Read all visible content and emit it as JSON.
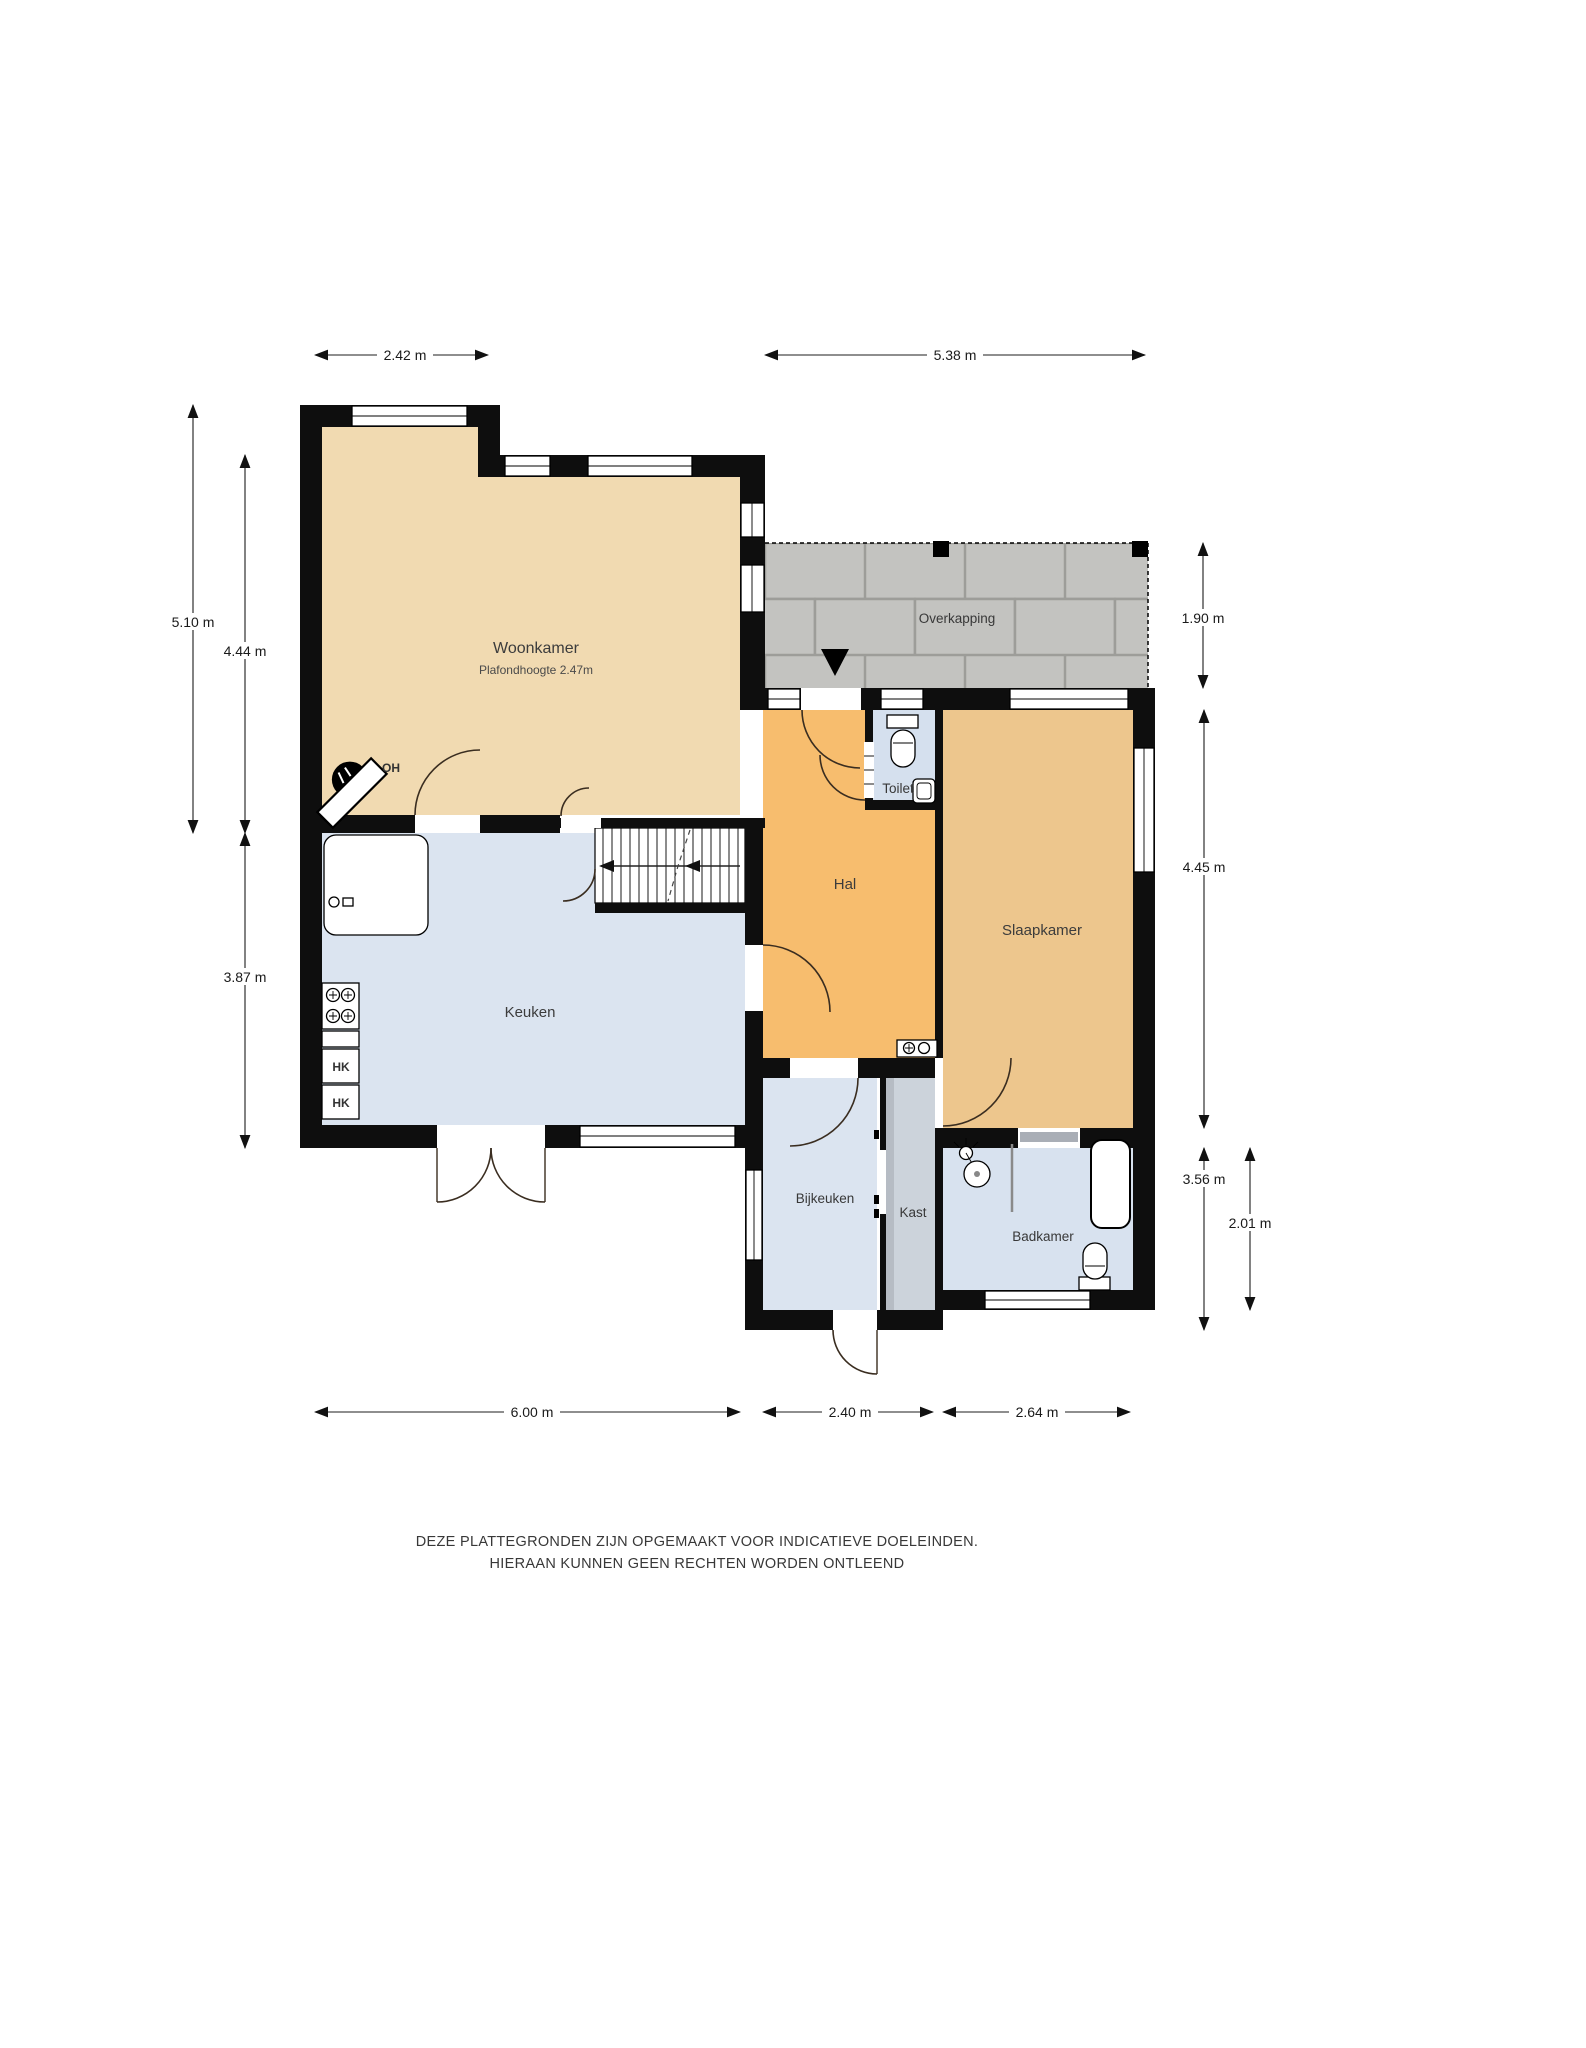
{
  "rooms": {
    "woonkamer": {
      "label": "Woonkamer",
      "sublabel": "Plafondhoogte 2.47m",
      "color": "#f1dab1"
    },
    "keuken": {
      "label": "Keuken",
      "color": "#dbe4f0"
    },
    "hal": {
      "label": "Hal",
      "color": "#f7bd6e"
    },
    "toilet": {
      "label": "Toilet",
      "color": "#d5e0ee"
    },
    "slaapkamer": {
      "label": "Slaapkamer",
      "color": "#edc68d"
    },
    "overkapping": {
      "label": "Overkapping",
      "color": "#b2b2af",
      "tile_color": "#c3c3c0"
    },
    "bijkeuken": {
      "label": "Bijkeuken",
      "color": "#dbe4f0"
    },
    "kast": {
      "label": "Kast",
      "color": "#ccd3db"
    },
    "badkamer": {
      "label": "Badkamer",
      "color": "#d8e2ef"
    }
  },
  "annotations": {
    "fireplace_label": "OH",
    "cabinet_label_1": "HK",
    "cabinet_label_2": "HK"
  },
  "dimensions": {
    "top_woonkamer": "2.42 m",
    "top_overkapping": "5.38 m",
    "left_woonkamer_outer": "5.10 m",
    "left_woonkamer_inner": "4.44 m",
    "left_keuken": "3.87 m",
    "right_overkapping": "1.90 m",
    "right_slaapkamer": "4.45 m",
    "right_bijkeuken": "3.56 m",
    "right_badkamer": "2.01 m",
    "bottom_keuken": "6.00 m",
    "bottom_bijkeuken": "2.40 m",
    "bottom_badkamer": "2.64 m"
  },
  "disclaimer": {
    "line1": "DEZE PLATTEGRONDEN ZIJN OPGEMAAKT VOOR INDICATIEVE DOELEINDEN.",
    "line2": "HIERAAN KUNNEN GEEN RECHTEN WORDEN ONTLEEND"
  },
  "colors": {
    "wall": "#0e0e0e"
  }
}
